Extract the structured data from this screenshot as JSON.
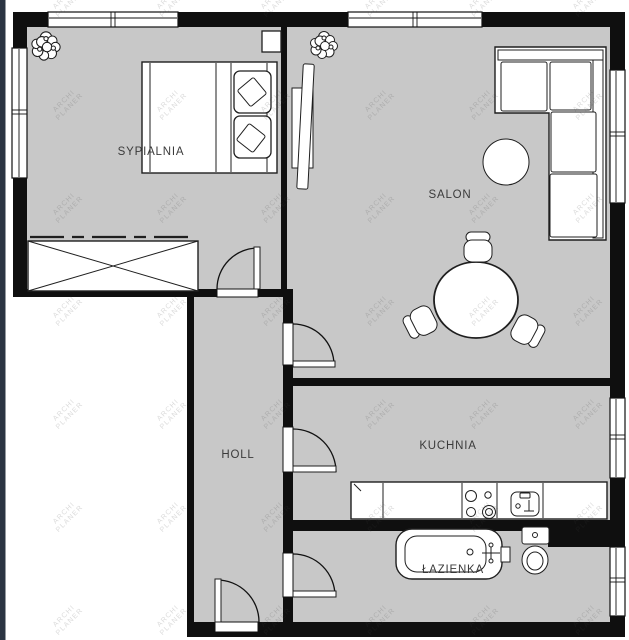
{
  "document": {
    "type": "apartment-floor-plan"
  },
  "colors": {
    "floor": "#c8c8c8",
    "wall": "#0f0f0f",
    "paper": "#ffffff",
    "furniture_stroke": "#1f1f1f",
    "label_text": "#3b3b3b",
    "left_edge_strip": "#2b3442",
    "watermark_text": "#464646"
  },
  "rooms": {
    "sypialnia": {
      "label": "SYPIALNIA"
    },
    "salon": {
      "label": "SALON"
    },
    "holl": {
      "label": "HOLL"
    },
    "kuchnia": {
      "label": "KUCHNIA"
    },
    "lazienka": {
      "label": "ŁAZIENKA"
    }
  },
  "watermark": {
    "line1": "ARCHI",
    "line2": "PLANER"
  }
}
